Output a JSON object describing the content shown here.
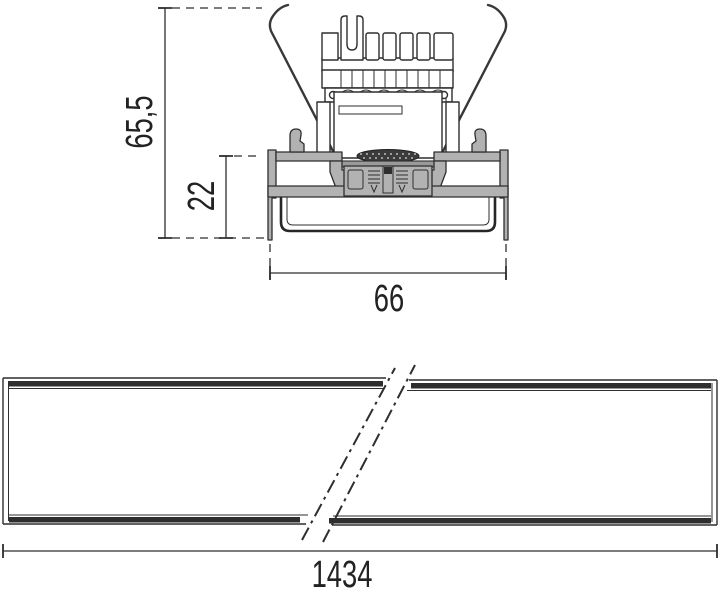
{
  "drawing": {
    "dimensions": {
      "overall_height": "65,5",
      "recess_depth": "22",
      "profile_width": "66",
      "length": "1434"
    },
    "colors": {
      "line": "#2e2e2e",
      "profile_fill": "#b2b2b2",
      "background": "#ffffff"
    }
  }
}
